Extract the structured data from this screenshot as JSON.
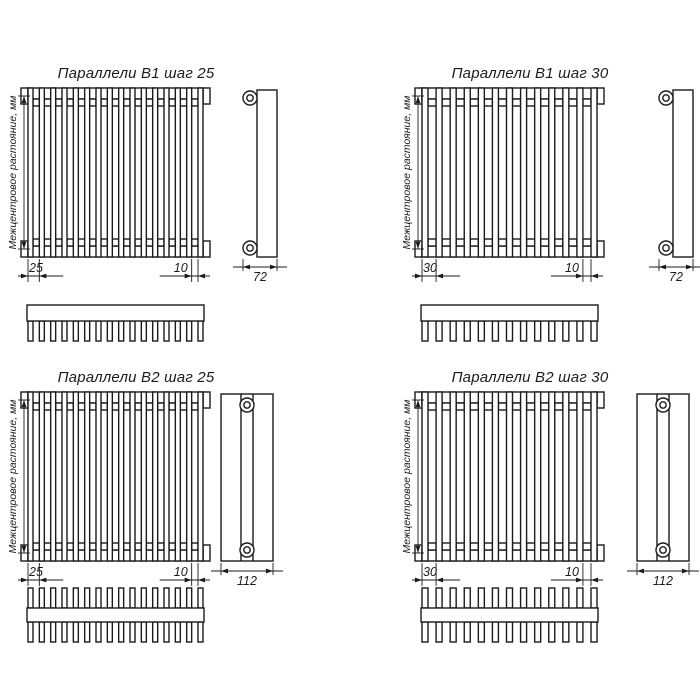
{
  "page": {
    "background": "#ffffff",
    "line_color": "#1b1b1b"
  },
  "drawings": [
    {
      "id": "parallels-v1-step-25",
      "title": "Параллели В1 шаг 25",
      "axis_label": "Межцентровое растояние, мм",
      "step_dim": "25",
      "gap_dim": "10",
      "depth_dim": "72",
      "tube_count": 16,
      "rows": 1
    },
    {
      "id": "parallels-v1-step-30",
      "title": "Параллели В1 шаг 30",
      "axis_label": "Межцентровое растояние, мм",
      "step_dim": "30",
      "gap_dim": "10",
      "depth_dim": "72",
      "tube_count": 13,
      "rows": 1
    },
    {
      "id": "parallels-v2-step-25",
      "title": "Параллели В2 шаг 25",
      "axis_label": "Межцентровое растояние, мм",
      "step_dim": "25",
      "gap_dim": "10",
      "depth_dim": "112",
      "tube_count": 16,
      "rows": 2
    },
    {
      "id": "parallels-v2-step-30",
      "title": "Параллели В2 шаг 30",
      "axis_label": "Межцентровое растояние, мм",
      "step_dim": "30",
      "gap_dim": "10",
      "depth_dim": "112",
      "tube_count": 13,
      "rows": 2
    }
  ]
}
